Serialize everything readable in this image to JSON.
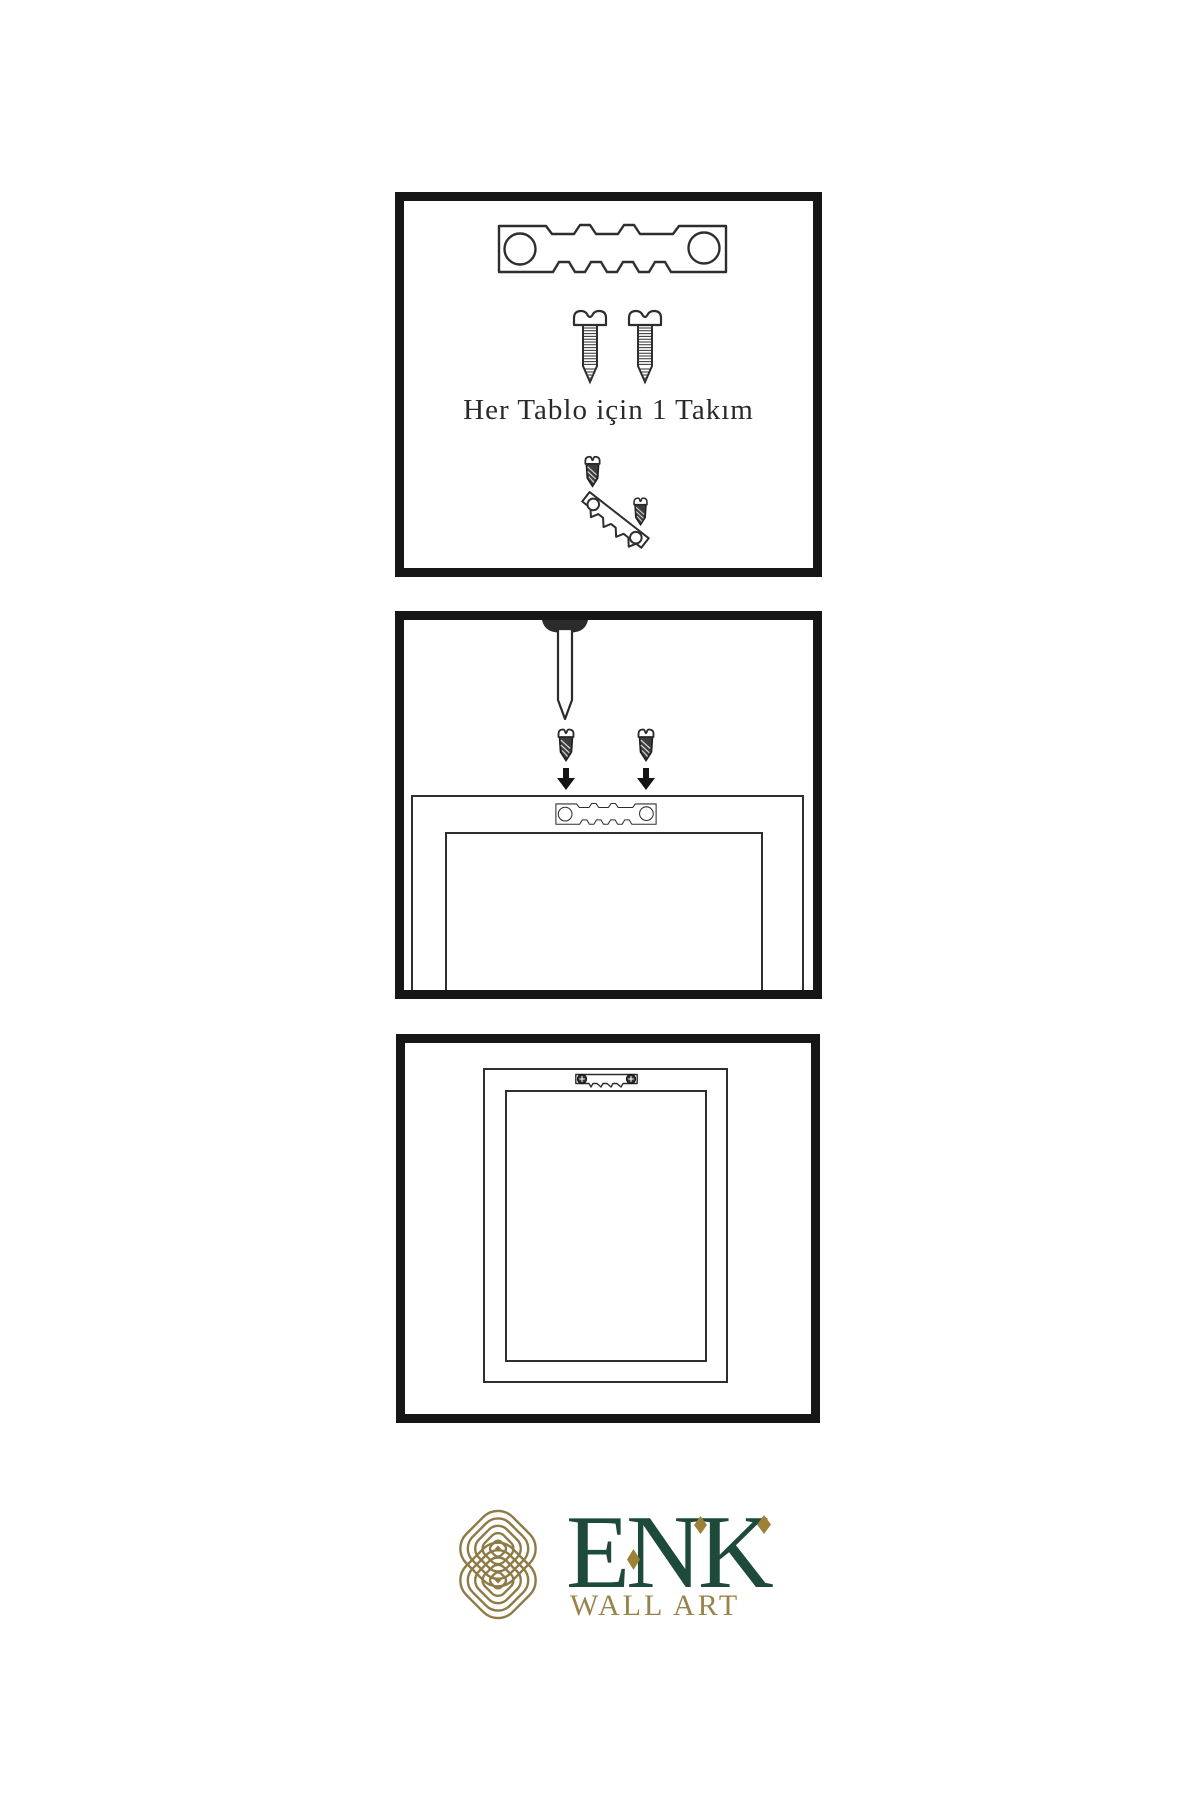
{
  "page": {
    "background": "#ffffff"
  },
  "colors": {
    "panel_border": "#161616",
    "illustration_outline": "#2e2e2e",
    "dark_metal": "#3c3c3c",
    "brand_green": "#1d4a3b",
    "brand_gold": "#8d7a45",
    "accent_gold": "#9c8136"
  },
  "steps": [
    {
      "name": "hardware-kit",
      "caption": "Her Tablo için 1 Takım",
      "icons": [
        "sawtooth-hanger-icon",
        "screw-icon",
        "screw-icon",
        "dark-screw-icon",
        "tilted-sawtooth-hanger-icon",
        "dark-screw-icon"
      ]
    },
    {
      "name": "attach-hanger-to-frame",
      "icons": [
        "wall-nail-icon",
        "dark-screw-icon",
        "down-arrow-icon",
        "dark-screw-icon",
        "down-arrow-icon",
        "sawtooth-hanger-icon",
        "frame-back-icon"
      ]
    },
    {
      "name": "hanger-mounted-on-frame",
      "icons": [
        "frame-back-icon",
        "sawtooth-hanger-screwed-icon"
      ]
    }
  ],
  "brand": {
    "name": "ENK",
    "tagline": "WALL ART",
    "logo": "interlocking-knot-icon"
  }
}
